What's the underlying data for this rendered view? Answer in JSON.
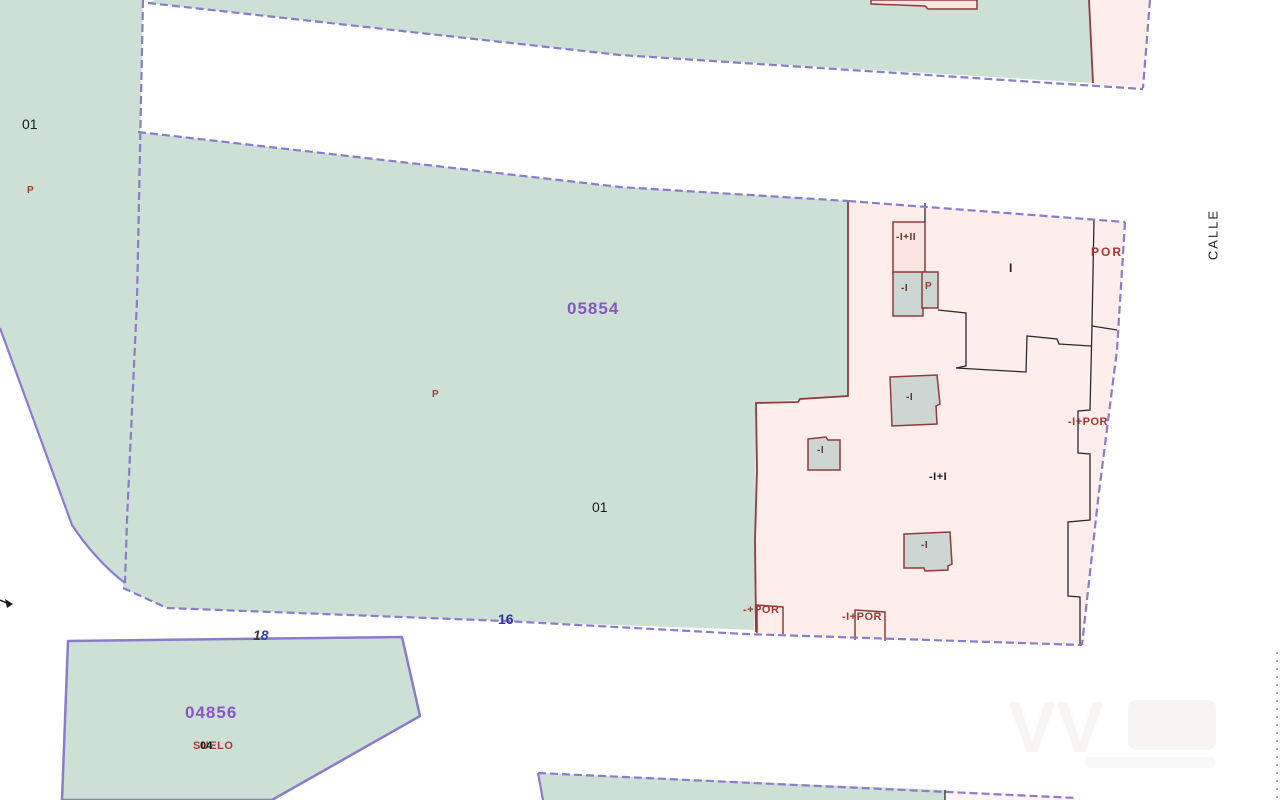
{
  "map_type": "cadastral-parcel-map",
  "street": {
    "name": "CALLE"
  },
  "parcels": {
    "left": {
      "zone": "01",
      "marker": "P"
    },
    "main": {
      "ref": "05854",
      "zone": "01",
      "marker": "P",
      "street_no": "16"
    },
    "south": {
      "ref": "04856",
      "land_label": "SUELO",
      "overlay_label": "04",
      "street_no_black": "1",
      "street_no_blue": "8"
    }
  },
  "buildings": {
    "top_small": "-I+II",
    "top_gray": "-I",
    "top_porch_p": "P",
    "courtyard": "I",
    "por_top_right": "POR",
    "mid_gray": "-I",
    "small_gray": "-I",
    "two_floor": "-I+I",
    "low_gray": "-I",
    "porch_left": "-+POR",
    "porch_mid": "-I+POR",
    "porch_right": "-I+POR"
  },
  "colors": {
    "parcel_teal": "#cde0d6",
    "parcel_pink": "#fdeeec",
    "building_pink": "#fae5e2",
    "building_gray": "#cdd6d2",
    "boundary_purple": "#8a7cc9",
    "building_red": "#8e3b3b",
    "label_purple": "#8955c5",
    "label_red": "#a83434",
    "label_blue": "#2d2db5",
    "road_white": "#ffffff"
  }
}
